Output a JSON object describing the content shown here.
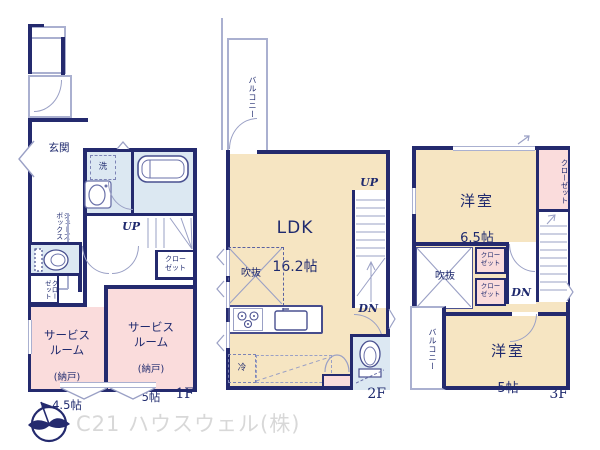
{
  "brand": {
    "name": "C21 ハウスウェル(株)"
  },
  "colors": {
    "wall": "#242a6e",
    "room_cream": "#f6e5c2",
    "room_pink": "#fadcdc",
    "room_blue": "#dce8f2",
    "light_line": "#aab0d0",
    "text": "#1f2a6e",
    "brand_text": "#d8d8d8"
  },
  "icons": {
    "compass": "north-compass-icon",
    "bathtub": "bathtub-icon",
    "vanity": "sink-vanity-icon",
    "toilet": "toilet-icon",
    "stove": "gas-stove-icon",
    "kitchen_sink": "kitchen-sink-icon",
    "stairs": "stairs-icon",
    "bifold_door": "bifold-door-icon",
    "void_cross": "open-ceiling-cross-icon"
  },
  "floor1": {
    "label": "1F",
    "entrance": "玄関",
    "laundry": "洗",
    "shoebox": "シューズ\nボックス",
    "up": "UP",
    "closet_rot": "クロー\nゼット",
    "closet_hall": "クロー\nゼット",
    "service_a": {
      "name": "サービス\nルーム",
      "note": "(納戸)",
      "size": "4.5帖"
    },
    "service_b": {
      "name": "サービス\nルーム",
      "note": "(納戸)",
      "size": "5帖"
    }
  },
  "floor2": {
    "label": "2F",
    "balcony": "バルコニー",
    "ldk": {
      "name": "LDK",
      "size": "16.2帖"
    },
    "up": "UP",
    "dn": "DN",
    "void": "吹抜",
    "fridge": "冷"
  },
  "floor3": {
    "label": "3F",
    "room_a": {
      "name": "洋室",
      "size": "6.5帖"
    },
    "room_b": {
      "name": "洋室",
      "size": "5帖"
    },
    "closet_right": "クローゼット",
    "closet_a": "クロー\nゼット",
    "closet_b": "クロー\nゼット",
    "void": "吹抜",
    "dn": "DN",
    "balcony": "バルコニー"
  }
}
